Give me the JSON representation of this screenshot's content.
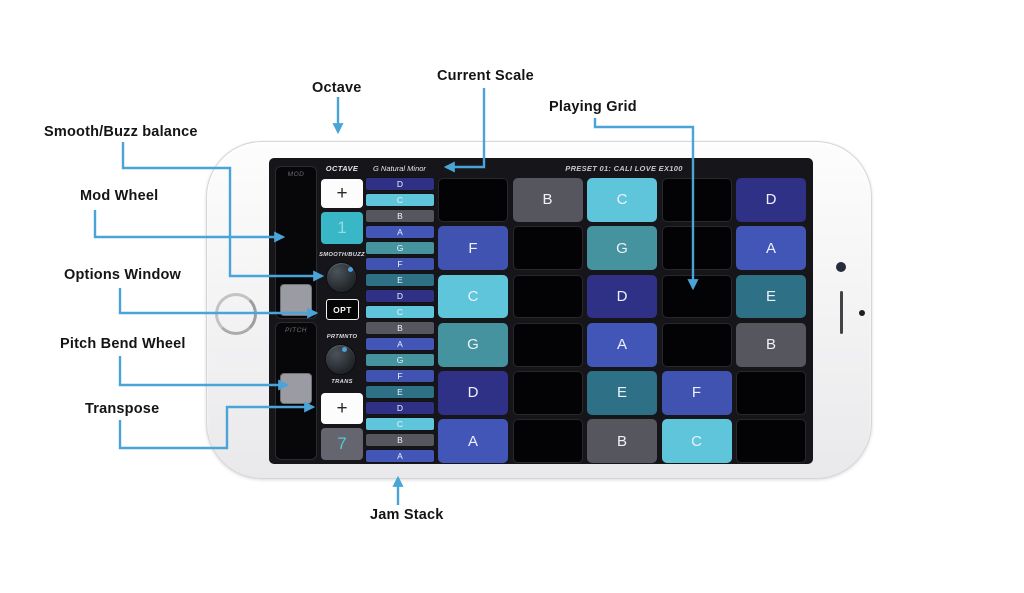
{
  "annotations": {
    "line_color": "#4ba4d8",
    "octave": "Octave",
    "current_scale": "Current Scale",
    "playing_grid": "Playing Grid",
    "smooth_buzz": "Smooth/Buzz balance",
    "mod_wheel": "Mod  Wheel",
    "options_window": "Options Window",
    "pitch_bend": "Pitch Bend Wheel",
    "transpose": "Transpose",
    "jam_stack": "Jam Stack"
  },
  "app": {
    "top_bar": {
      "octave_label": "OCTAVE",
      "scale_name": "G Natural Minor",
      "preset": "PRESET 01: CALI LOVE EX100"
    },
    "wheels": {
      "mod_label": "MOD",
      "pitch_label": "PITCH"
    },
    "controls": {
      "octave_plus_label": "+",
      "octave_value": "1",
      "smooth_buzz_label": "SMOOTH/BUZZ",
      "opt_label": "OPT",
      "portamento_label": "PRTMNTO",
      "transpose_label": "TRANS",
      "transpose_plus_label": "+",
      "transpose_value": "7",
      "octave_value_bg": "#39b7c7",
      "octave_value_fg": "#94dbe4",
      "transpose_value_bg": "#65656f",
      "transpose_value_fg": "#55c8d2"
    },
    "jam_stack_notes": [
      "D",
      "C",
      "B",
      "A",
      "G",
      "F",
      "E",
      "D",
      "C",
      "B",
      "A",
      "G",
      "F",
      "E",
      "D",
      "C",
      "B",
      "A"
    ],
    "grid_rows": [
      [
        "",
        "B",
        "C",
        "",
        "D"
      ],
      [
        "F",
        "",
        "G",
        "",
        "A"
      ],
      [
        "C",
        "",
        "D",
        "",
        "E"
      ],
      [
        "G",
        "",
        "A",
        "",
        "B"
      ],
      [
        "D",
        "",
        "E",
        "F",
        ""
      ],
      [
        "A",
        "",
        "B",
        "C",
        ""
      ]
    ],
    "note_colors": {
      "A": "#4156b7",
      "B": "#56565e",
      "C": "#5ec5da",
      "D": "#2e3186",
      "E": "#2e7187",
      "F": "#4153b1",
      "G": "#44939f"
    }
  }
}
